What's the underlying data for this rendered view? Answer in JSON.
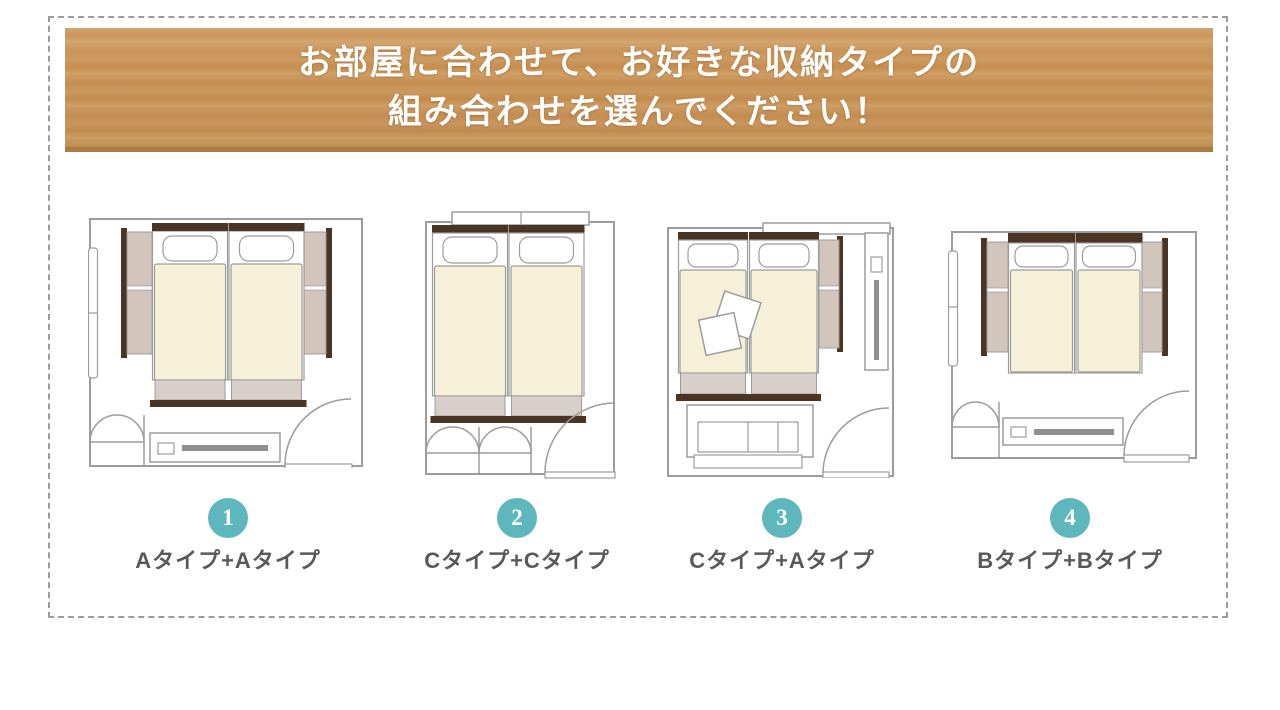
{
  "header": {
    "line1": "お部屋に合わせて、お好きな収納タイプの",
    "line2": "組み合わせを選んでください！"
  },
  "plans": [
    {
      "number": "1",
      "label": "Aタイプ+Aタイプ"
    },
    {
      "number": "2",
      "label": "Cタイプ+Cタイプ"
    },
    {
      "number": "3",
      "label": "Cタイプ+Aタイプ"
    },
    {
      "number": "4",
      "label": "Bタイプ+Bタイプ"
    }
  ],
  "colors": {
    "accent_teal": "#5db7bd",
    "wood_banner": "#c9945a",
    "wood_banner_edge": "#ab7c41",
    "plan_line_gray": "#9c9c9c",
    "bed_cream": "#f6f0d8",
    "bed_footer_gray": "#d9cfca",
    "dark_wood": "#4a3423",
    "storage_panel_tan": "#d1c5bc",
    "label_text": "#595959"
  }
}
